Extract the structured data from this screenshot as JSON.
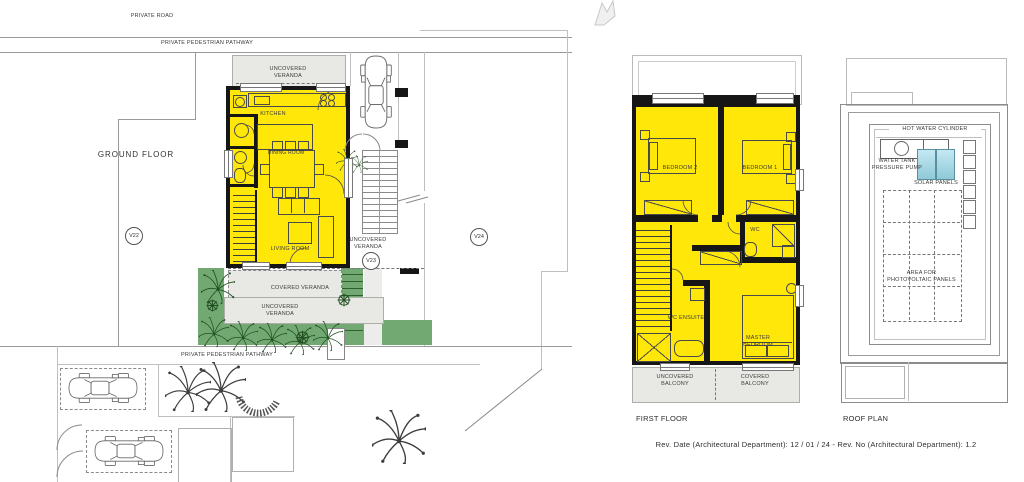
{
  "plans": {
    "ground_floor": {
      "title": "GROUND FLOOR",
      "labels": {
        "private_road": "PRIVATE ROAD",
        "pedestrian_pathway_top": "PRIVATE PEDESTRIAN PATHWAY",
        "pedestrian_pathway_bottom": "PRIVATE PEDESTRIAN PATHWAY",
        "uncovered_veranda_top": "UNCOVERED VERANDA",
        "kitchen": "KITCHEN",
        "dining_room": "DINING ROOM",
        "living_room": "LIVING ROOM",
        "uncovered_veranda_side": "UNCOVERED VERANDA",
        "covered_veranda": "COVERED VERANDA",
        "uncovered_veranda_bottom": "UNCOVERED VERANDA",
        "marker_v22": "V22",
        "marker_v23": "V23",
        "marker_v24": "V24"
      }
    },
    "first_floor": {
      "title": "FIRST FLOOR",
      "labels": {
        "bedroom_2": "BEDROOM 2",
        "bedroom_1": "BEDROOM 1",
        "wc": "WC",
        "wc_ensuite": "WC ENSUITE",
        "master_bedroom": "MASTER BEDROOM",
        "uncovered_balcony": "UNCOVERED BALCONY",
        "covered_balcony": "COVERED BALCONY"
      }
    },
    "roof_plan": {
      "title": "ROOF PLAN",
      "labels": {
        "hot_water_cylinder": "HOT WATER CYLINDER",
        "water_tank_pressure_pump": "WATER TANK PRESSURE PUMP",
        "solar_panels": "SOLAR PANELS",
        "photovoltaic_area": "AREA FOR PHOTOVOLTAIC PANELS"
      }
    }
  },
  "footer": {
    "revision_note": "Rev. Date (Architectural Department): 12 / 01 / 24 - Rev. No (Architectural Department): 1.2"
  },
  "colors": {
    "room_yellow": "#FFE70A",
    "wall_black": "#161616",
    "veranda_grey": "#E8E8E4",
    "landscape_green": "#72A872",
    "solar_panel_blue": "#C4E9F2"
  }
}
